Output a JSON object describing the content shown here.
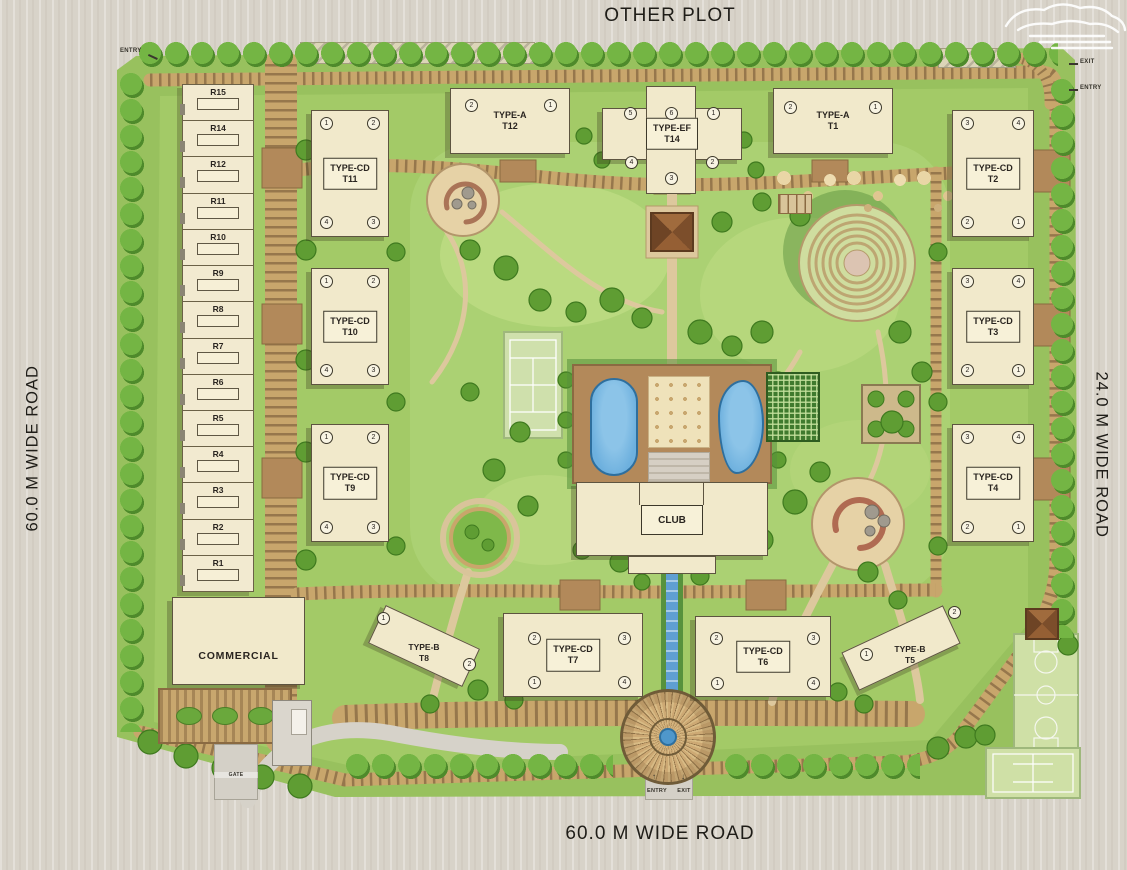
{
  "site": {
    "other_plot_label": "OTHER PLOT",
    "left_road_label": "60.0 M WIDE ROAD",
    "right_road_label": "24.0 M WIDE ROAD",
    "bottom_road_label": "60.0 M WIDE ROAD"
  },
  "access": {
    "top_left_entry": "ENTRY",
    "top_right_exit": "EXIT",
    "top_right_entry": "ENTRY",
    "bottom_entry": "ENTRY",
    "bottom_exit": "EXIT",
    "bottom_entry_arrow": "↑",
    "bottom_exit_arrow": "↓",
    "gate": "GATE"
  },
  "rowhouses": {
    "labels": [
      "R15",
      "R14",
      "R12",
      "R11",
      "R10",
      "R9",
      "R8",
      "R7",
      "R6",
      "R5",
      "R4",
      "R3",
      "R2",
      "R1"
    ]
  },
  "buildings": {
    "commercial": "COMMERCIAL",
    "club": "CLUB"
  },
  "towers": {
    "t12": {
      "type": "TYPE-A",
      "code": "T12",
      "units": {
        "a": "2",
        "b": "1"
      }
    },
    "t14": {
      "type": "TYPE-EF",
      "code": "T14",
      "units": {
        "n1": "5",
        "n2": "6",
        "n3": "1",
        "n4": "4",
        "n5": "2",
        "n6": "3"
      }
    },
    "t1": {
      "type": "TYPE-A",
      "code": "T1",
      "units": {
        "a": "2",
        "b": "1"
      }
    },
    "t11": {
      "type": "TYPE-CD",
      "code": "T11",
      "units": {
        "tl": "1",
        "tr": "2",
        "bl": "4",
        "br": "3"
      }
    },
    "t10": {
      "type": "TYPE-CD",
      "code": "T10",
      "units": {
        "tl": "1",
        "tr": "2",
        "bl": "4",
        "br": "3"
      }
    },
    "t9": {
      "type": "TYPE-CD",
      "code": "T9",
      "units": {
        "tl": "1",
        "tr": "2",
        "bl": "4",
        "br": "3"
      }
    },
    "t2": {
      "type": "TYPE-CD",
      "code": "T2",
      "units": {
        "tl": "3",
        "tr": "4",
        "bl": "2",
        "br": "1"
      }
    },
    "t3": {
      "type": "TYPE-CD",
      "code": "T3",
      "units": {
        "tl": "3",
        "tr": "4",
        "bl": "2",
        "br": "1"
      }
    },
    "t4": {
      "type": "TYPE-CD",
      "code": "T4",
      "units": {
        "tl": "3",
        "tr": "4",
        "bl": "2",
        "br": "1"
      }
    },
    "t8": {
      "type": "TYPE-B",
      "code": "T8",
      "units": {
        "a": "1",
        "b": "2"
      }
    },
    "t7": {
      "type": "TYPE-CD",
      "code": "T7",
      "units": {
        "tl": "2",
        "tr": "3",
        "bl": "1",
        "br": "4"
      }
    },
    "t6": {
      "type": "TYPE-CD",
      "code": "T6",
      "units": {
        "tl": "2",
        "tr": "3",
        "bl": "1",
        "br": "4"
      }
    },
    "t5": {
      "type": "TYPE-B",
      "code": "T5",
      "units": {
        "a": "1",
        "b": "2"
      }
    }
  },
  "colors": {
    "site_green": "#98c15e",
    "road_tan": "#c8a66c",
    "building_cream": "#f1e9cb",
    "pool_blue": "#6db0de",
    "outside_beige": "#d8d3c9"
  }
}
